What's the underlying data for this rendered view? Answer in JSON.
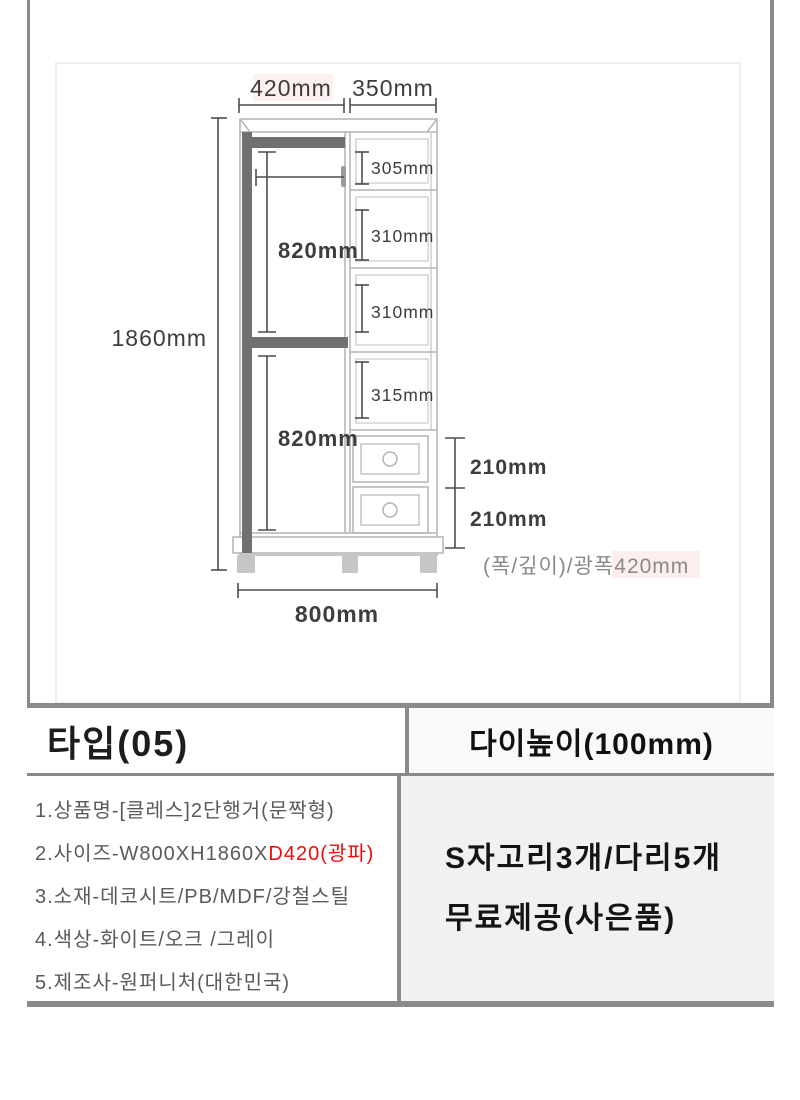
{
  "diagram": {
    "top_width_left": "420mm",
    "top_width_right": "350mm",
    "total_height": "1860mm",
    "hanging_upper": "820mm",
    "hanging_lower": "820mm",
    "shelf_1": "305mm",
    "shelf_2": "310mm",
    "shelf_3": "310mm",
    "shelf_4": "315mm",
    "drawer_upper": "210mm",
    "drawer_lower": "210mm",
    "total_width": "800mm",
    "depth_note": "(폭/깊이)/광폭",
    "depth_value": "420mm"
  },
  "table": {
    "header": {
      "type_label": "타입(05)",
      "stand_height_label": "다이높이(100mm)"
    },
    "specs": {
      "line1": "1.상품명-[클레스]2단행거(문짝형)",
      "line2_prefix": "2.사이즈-W800XH1860X",
      "line2_red": "D420(광파)",
      "line3": "3.소재-데코시트/PB/MDF/강철스틸",
      "line4": "4.색상-화이트/오크 /그레이",
      "line5": "5.제조사-원퍼니처(대한민국)"
    },
    "gift": {
      "line1": "S자고리3개/다리5개",
      "line2": "무료제공(사은품)"
    }
  },
  "colors": {
    "frame": "#8a8a8a",
    "dimension_line": "#4d4d4d",
    "cabinet_line": "#b4b4b4",
    "dark_part": "#707070",
    "feet": "#c6c6c6",
    "red_text": "#ef0b0b",
    "gift_background": "#f2f0f0",
    "pink_highlight": "#fdeeee"
  }
}
